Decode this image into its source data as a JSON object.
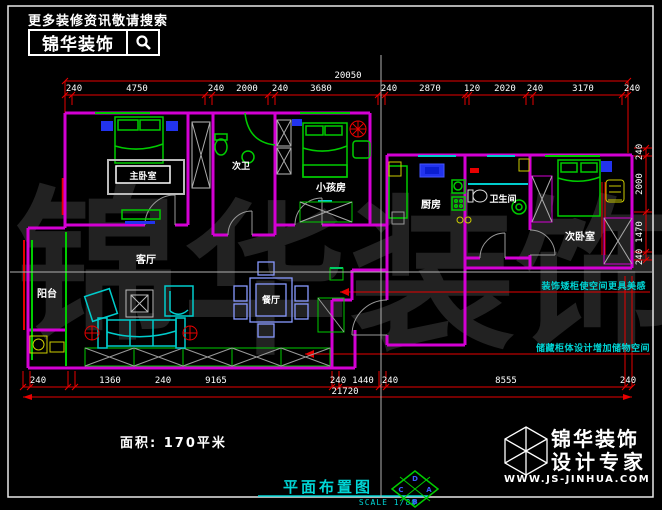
{
  "header": {
    "tagline": "更多装修资讯敬请搜索",
    "brand": "锦华装饰"
  },
  "watermark": {
    "chars": [
      "锦",
      "华",
      "装",
      "饰"
    ]
  },
  "rooms": {
    "master": "主卧室",
    "bath2": "次卫",
    "kids": "小孩房",
    "living": "客厅",
    "balcony": "阳台",
    "dining": "餐厅",
    "kitchen": "厨房",
    "bathroom": "卫生间",
    "bedroom2": "次卧室"
  },
  "dims": {
    "top_total": "20050",
    "top": [
      "240",
      "4750",
      "240",
      "2000",
      "240",
      "3680",
      "240",
      "2870",
      "120",
      "2020",
      "240",
      "3170",
      "240"
    ],
    "bottom_total": "21720",
    "bottom": [
      "240",
      "1360",
      "240",
      "9165",
      "240",
      "1440",
      "240",
      "8555",
      "240"
    ],
    "right": [
      "240",
      "2000",
      "1470",
      "240"
    ]
  },
  "annotations": {
    "a1": "装饰矮柜使空间更具美感",
    "a2": "储藏柜体设计增加储物空间"
  },
  "footer": {
    "area": "面积: 170平米",
    "title": "平面布置图",
    "scale": "SCALE 1/80",
    "stamp": {
      "top": "D",
      "left": "C",
      "right": "A",
      "bottom": "B"
    },
    "brand": "锦华装饰",
    "brand_sub": "设计专家",
    "website": "WWW.JS-JINHUA.COM"
  },
  "colors": {
    "wall": "#d400d4",
    "dimension": "#e80000",
    "furniture": "#00cc00",
    "soft_furniture": "#00cccc",
    "accent_blue": "#2233ee",
    "accent_yellow": "#cccc00",
    "text": "#ffffff",
    "annotation": "#00d5d5"
  }
}
